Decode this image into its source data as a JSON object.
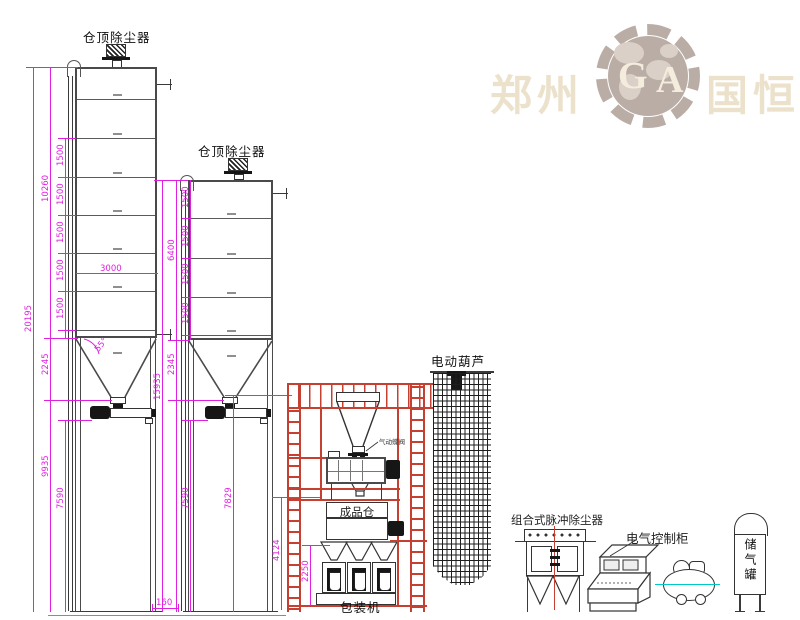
{
  "watermark": {
    "city": "郑州",
    "letter_g": "G",
    "letter_a": "A",
    "name": "国恒"
  },
  "silo_labels": {
    "left": "仓顶除尘器",
    "mid": "仓顶除尘器"
  },
  "dims": {
    "total_left": "20195",
    "shell_left": "10260",
    "cone_left": "2245",
    "legs_left": "9935",
    "legs_left2": "7590",
    "ring": "1500",
    "width": "3000",
    "cone_angle": "55°",
    "total_mid": "15935",
    "shell_mid": "6400",
    "cone_mid": "2345",
    "legs_mid": "7590",
    "mid_outlet_height": "7829",
    "platform_height": "4124",
    "packer_height": "2250",
    "gap": "160"
  },
  "equipment": {
    "hoist": "电动葫芦",
    "valve": "气动蝶阀",
    "product_bin": "成品仓",
    "packing_machine": "包装机",
    "dust_filter": "组合式脉冲除尘器",
    "control_cabinet": "电气控制柜",
    "air_tank": "储气罐"
  },
  "colors": {
    "dimension": "#e020e0",
    "structure_red": "#c54030",
    "line_dark": "#3a3a3a",
    "ground_cyan": "#00c8c8",
    "watermark_text": "#ebe1ca",
    "watermark_gear": "#b7a9a2"
  }
}
